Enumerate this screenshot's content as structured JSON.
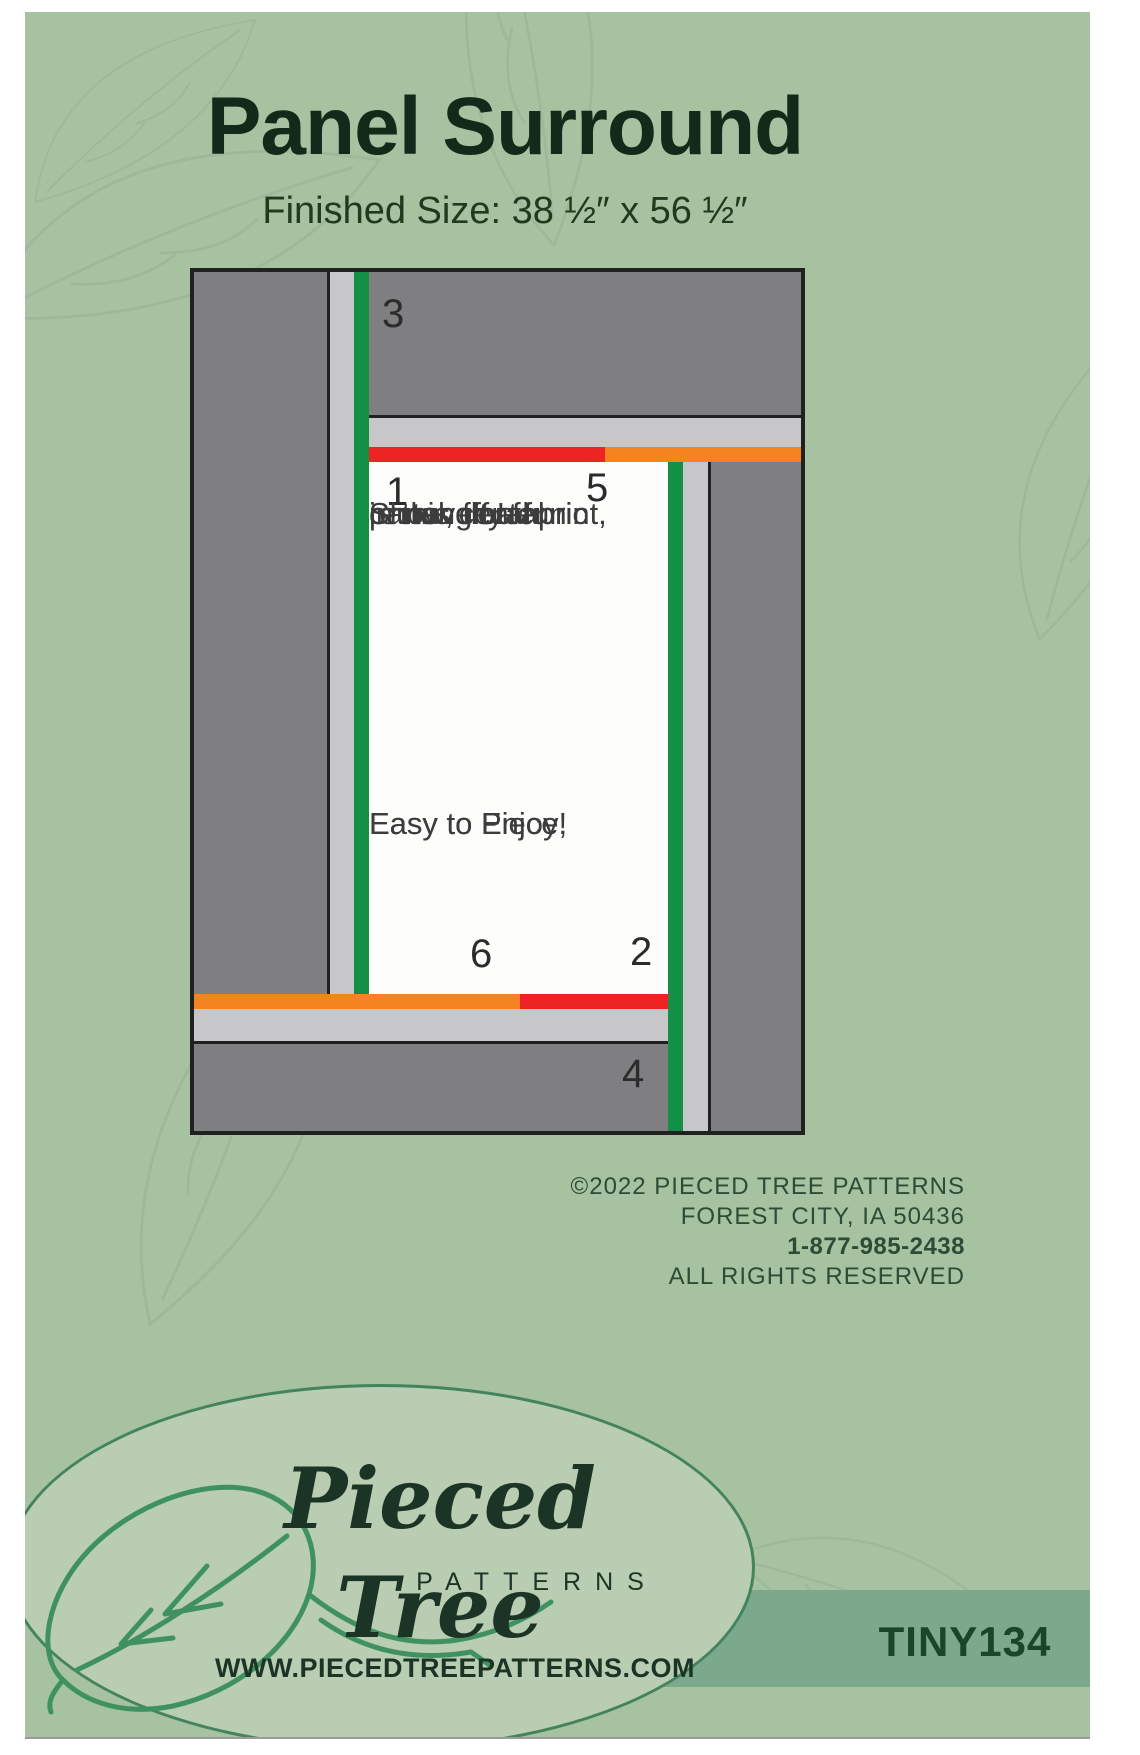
{
  "header": {
    "title": "Panel Surround",
    "subtitle": "Finished Size: 38 ½″ x 56 ½″"
  },
  "diagram": {
    "labels": {
      "border1": "1",
      "border2": "2",
      "border3": "3",
      "border4": "4",
      "border5": "5",
      "border6": "6"
    },
    "center_text": {
      "para1": [
        "Show off a fun",
        "panel, floral print,",
        "or novelty fabric",
        "in this center",
        "rectangle!"
      ],
      "para2": [
        "Easy to Piece,",
        "Easy to Enjoy!"
      ]
    },
    "colors": {
      "dark_gray": "#7f7f81",
      "light_gray": "#c7c7c9",
      "green_strip": "#148f46",
      "red_strip": "#ee2424",
      "orange_strip": "#f5831f",
      "outline": "#212121",
      "center_bg": "#fdfdfc"
    }
  },
  "footer": {
    "copyright_line1": "©2022 PIECED TREE PATTERNS",
    "copyright_line2": "FOREST CITY, IA 50436",
    "phone": "1-877-985-2438",
    "rights": "ALL RIGHTS RESERVED",
    "logo": {
      "script": "Pieced Tree",
      "word": "PATTERNS",
      "website": "WWW.PIECEDTREEPATTERNS.COM"
    },
    "sku": "TINY134"
  },
  "colors": {
    "cover_background": "#a7c2a1",
    "oval_fill": "#b8cdb1",
    "oval_stroke": "#43845d",
    "sku_band": "#7ca98c",
    "title_text": "#122a1a",
    "footer_text": "#2d4b35",
    "logo_text": "#1c3425"
  }
}
